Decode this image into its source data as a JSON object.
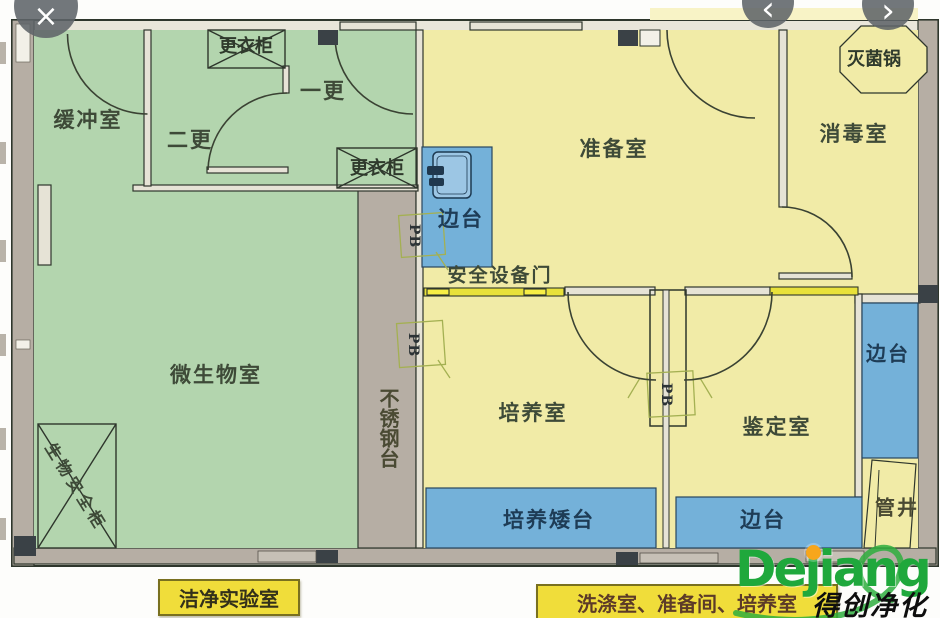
{
  "viewer": {
    "close_label": "×",
    "prev_label": "‹",
    "next_label": "›"
  },
  "plan": {
    "rooms": {
      "buffer_room": "缓冲室",
      "second_change": "二更",
      "first_change": "一更",
      "prep_room": "准备室",
      "disinfect_room": "消毒室",
      "micro_room": "微生物室",
      "culture_room": "培养室",
      "id_room": "鉴定室",
      "pipe_shaft": "管井"
    },
    "fixtures": {
      "wardrobe_top": "更衣柜",
      "wardrobe_bottom": "更衣柜",
      "sterilizer": "灭菌锅",
      "side_bench_left": "边台",
      "side_bench_right": "边台",
      "side_bench_bottom": "边台",
      "culture_low_bench": "培养矮台",
      "safety_door": "安全设备门",
      "steel_bench": "不锈钢台",
      "biosafety_cabinet": "生物安全柜",
      "passbox_1": "PB",
      "passbox_2": "PB",
      "passbox_3": "PB"
    },
    "captions": {
      "clean_lab": "洁净实验室",
      "wash_area": "洗涤室、准备间、培养室"
    },
    "colors": {
      "clean_zone": "#b3d5ae",
      "work_zone": "#f1eba7",
      "bench_blue": "#74b1d9",
      "wall_gray": "#b6aea4",
      "sill_yellow": "#e8e13a",
      "caption_bg": "#f0dd3a"
    }
  },
  "watermark": {
    "brand": "Dejiang",
    "slogan": "得创净化",
    "brand_color": "#1fa83c",
    "dot_color": "#f7a61b"
  }
}
